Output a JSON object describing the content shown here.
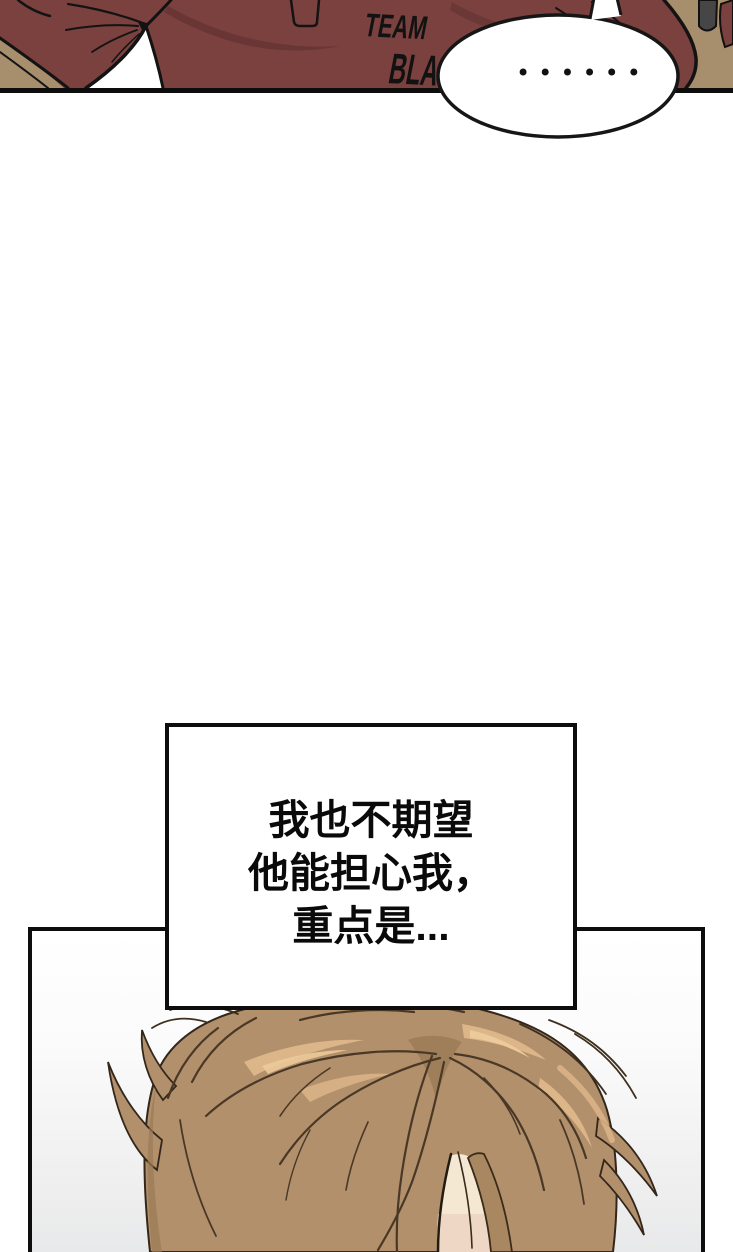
{
  "page": {
    "background": "#ffffff",
    "width_px": 733,
    "height_px": 1252
  },
  "top_panel": {
    "alt": "cropped torso of a person wearing a dark red polo shirt",
    "shirt_text_line1": "TEAM",
    "shirt_text_line2": "BLA",
    "speech_bubble": {
      "dots_text": "••••••"
    },
    "colors": {
      "shirt": "#7a413e",
      "shirt_shadow": "#663434",
      "background_tan": "#a78e6d",
      "dark_corner_object": "#464646",
      "line": "#131313",
      "panel_border": "#0d0d0d",
      "bubble_fill": "#ffffff",
      "bubble_stroke": "#161616"
    }
  },
  "narration_box": {
    "lines": [
      "我也不期望",
      "他能担心我，",
      "重点是..."
    ],
    "text_color": "#0a0a0a",
    "border_color": "#0d0d0d",
    "background": "#ffffff"
  },
  "bottom_panel": {
    "alt": "top of a bowed head of light brown hair",
    "colors": {
      "hair_base": "#b2906b",
      "hair_shadow": "#9a7a56",
      "hair_highlight": "#dcb588",
      "hair_highlight_light": "#ecca9b",
      "hair_line": "#4a3826",
      "skin": "#f4e8d3",
      "skin_warm": "#eed7c4",
      "background_top": "#ffffff",
      "background_bottom": "#e8e9ea",
      "border": "#0d0d0d"
    }
  }
}
